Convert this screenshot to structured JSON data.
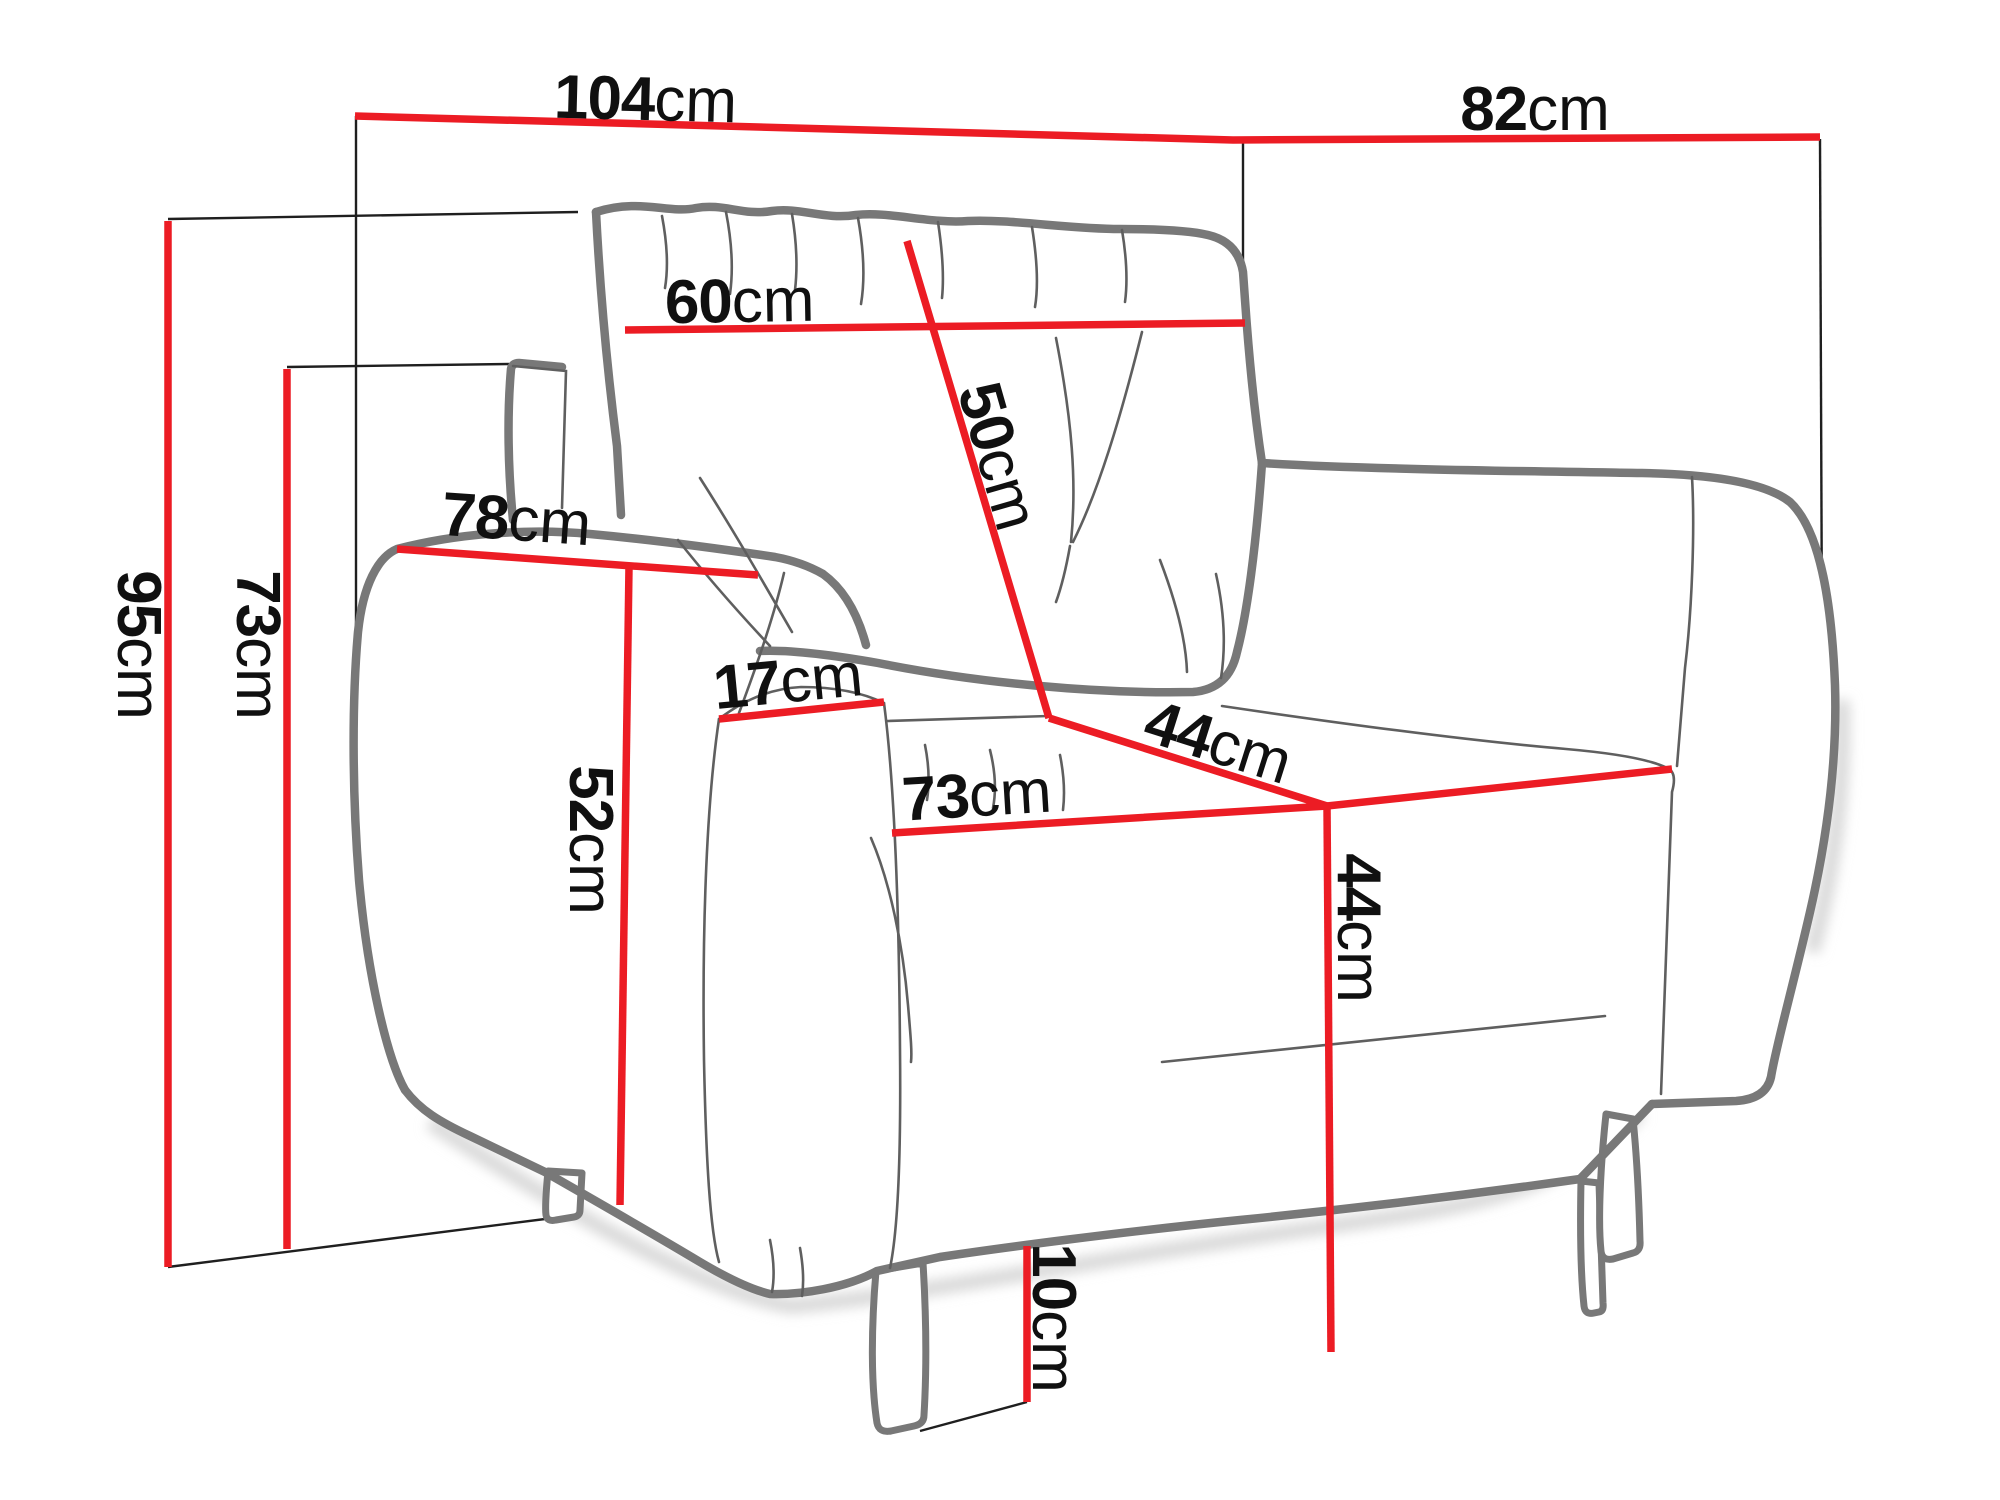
{
  "diagram": {
    "type": "furniture-dimension-diagram",
    "subject": "armchair line drawing with dimension callouts",
    "unit": "cm",
    "colors": {
      "dimension_line": "#ec1c24",
      "extension_line": "#1f1f1f",
      "chair_outline": "#787878",
      "chair_detail": "#5f5f5f",
      "shadow": "#d8d8d8",
      "label": "#101010",
      "background": "#ffffff"
    },
    "dims": {
      "overall_width": {
        "value": "104",
        "unit": "cm"
      },
      "overall_depth": {
        "value": "82",
        "unit": "cm"
      },
      "back_cushion_width": {
        "value": "60",
        "unit": "cm"
      },
      "back_cushion_height": {
        "value": "50",
        "unit": "cm"
      },
      "armrest_length": {
        "value": "78",
        "unit": "cm"
      },
      "armrest_width": {
        "value": "17",
        "unit": "cm"
      },
      "overall_height": {
        "value": "95",
        "unit": "cm"
      },
      "armrest_height": {
        "value": "73",
        "unit": "cm"
      },
      "armrest_side_height": {
        "value": "52",
        "unit": "cm"
      },
      "seat_depth": {
        "value": "73",
        "unit": "cm"
      },
      "seat_width": {
        "value": "44",
        "unit": "cm"
      },
      "seat_height": {
        "value": "44",
        "unit": "cm"
      },
      "leg_height": {
        "value": "10",
        "unit": "cm"
      }
    }
  }
}
